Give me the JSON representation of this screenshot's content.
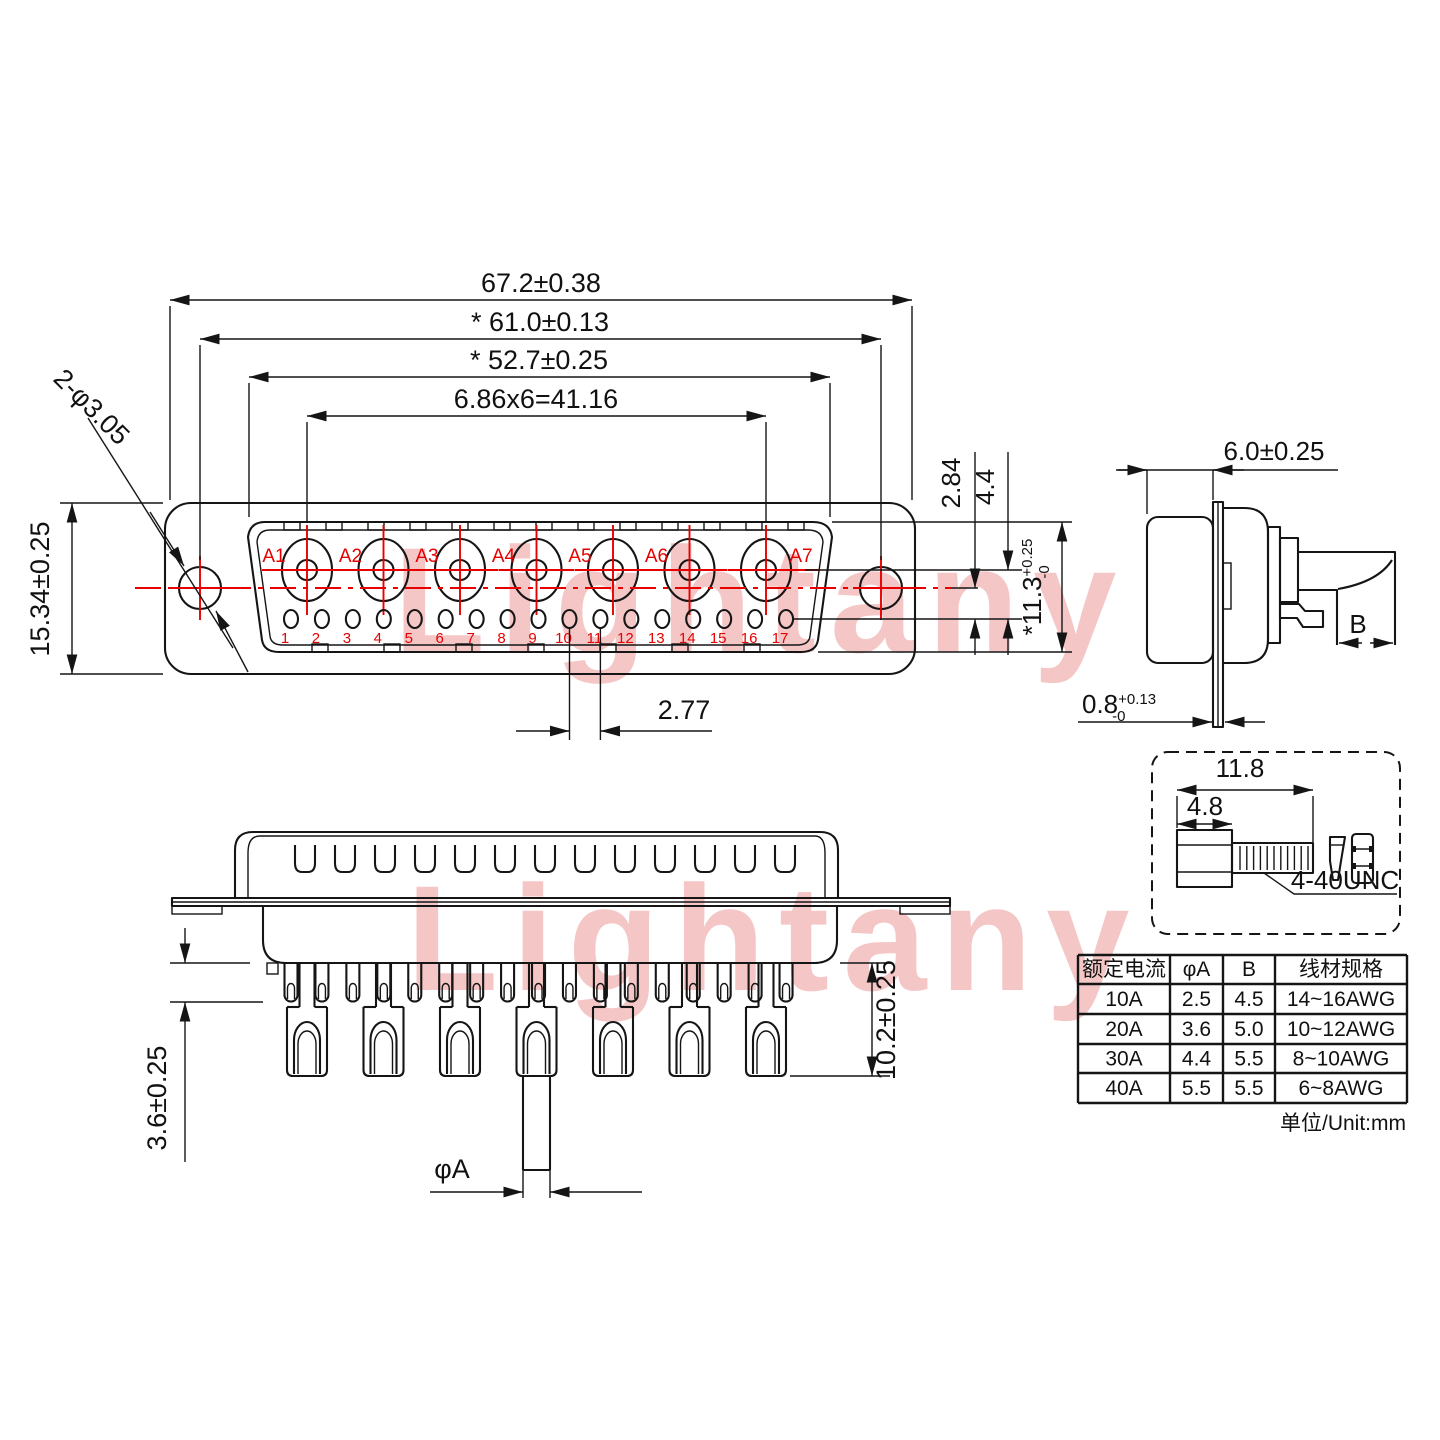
{
  "watermark": {
    "text": "Lightany"
  },
  "front_view": {
    "pin_labels": [
      "A1",
      "A2",
      "A3",
      "A4",
      "A5",
      "A6",
      "A7"
    ],
    "pin_numbers": [
      "1",
      "2",
      "3",
      "4",
      "5",
      "6",
      "7",
      "8",
      "9",
      "10",
      "11",
      "12",
      "13",
      "14",
      "15",
      "16",
      "17"
    ],
    "dims": {
      "overall_width": "67.2±0.38",
      "mount_span": "* 61.0±0.13",
      "shell_width": "* 52.7±0.25",
      "pin_pitch_total": "6.86x6=41.16",
      "hole_callout": "2-φ3.05",
      "flange_height": "15.34±0.25",
      "center_to_row": "2.84",
      "row_gap": "4.4",
      "shell_height_main": "*11.3",
      "shell_height_plus": "+0.25",
      "shell_height_minus": "-0",
      "small_pin_pitch": "2.77"
    }
  },
  "side_view": {
    "dims": {
      "depth": "6.0±0.25",
      "wire_width": "B",
      "plate_main": "0.8",
      "plate_plus": "+0.13",
      "plate_minus": "-0"
    }
  },
  "bottom_view": {
    "dims": {
      "insulator_gap": "3.6±0.25",
      "cup_length": "10.2±0.25",
      "pin_diameter": "φA"
    }
  },
  "screw_detail": {
    "dims": {
      "total_length": "11.8",
      "head_length": "4.8"
    },
    "thread_label": "4-40UNC"
  },
  "table": {
    "headers": [
      "额定电流",
      "φA",
      "B",
      "线材规格"
    ],
    "rows": [
      [
        "10A",
        "2.5",
        "4.5",
        "14~16AWG"
      ],
      [
        "20A",
        "3.6",
        "5.0",
        "10~12AWG"
      ],
      [
        "30A",
        "4.4",
        "5.5",
        "8~10AWG"
      ],
      [
        "40A",
        "5.5",
        "5.5",
        "6~8AWG"
      ]
    ],
    "unit_note": "单位/Unit:mm"
  }
}
